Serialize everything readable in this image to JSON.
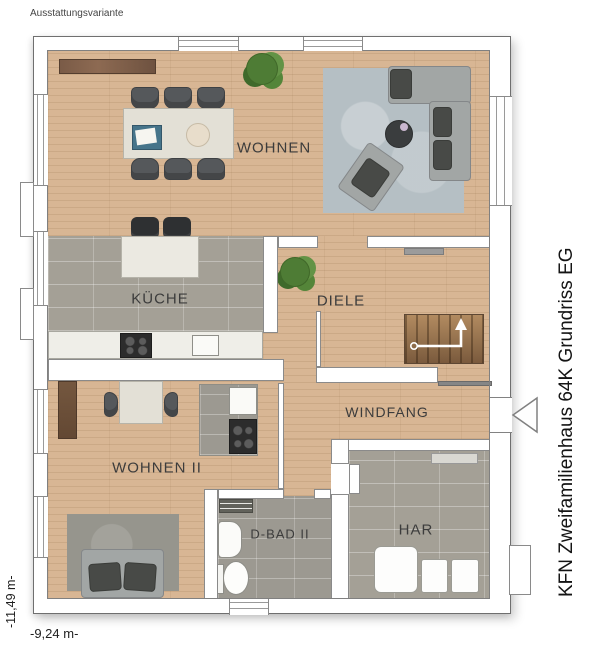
{
  "header": {
    "variant_label": "Ausstattungsvariante"
  },
  "title": {
    "vertical_label": "KFN Zweifamilienhaus 64K Grundriss EG"
  },
  "dimensions": {
    "width": "-9,24 m-",
    "height": "-11,49 m-"
  },
  "rooms": [
    {
      "name": "wohnen",
      "label": "WOHNEN"
    },
    {
      "name": "kueche",
      "label": "KÜCHE"
    },
    {
      "name": "diele",
      "label": "DIELE"
    },
    {
      "name": "windfang",
      "label": "WINDFANG"
    },
    {
      "name": "wohnen-ii",
      "label": "WOHNEN II"
    },
    {
      "name": "d-bad-ii",
      "label": "D-BAD II"
    },
    {
      "name": "har",
      "label": "HAR"
    }
  ],
  "colors": {
    "wood": "#d8b694",
    "tile": "#a4a096",
    "rug_living": "#b5bfc4",
    "rug_lounge": "#96958d",
    "wall": "#ffffff",
    "outline": "#7d7d7d",
    "label_text": "#3c3c3c"
  }
}
